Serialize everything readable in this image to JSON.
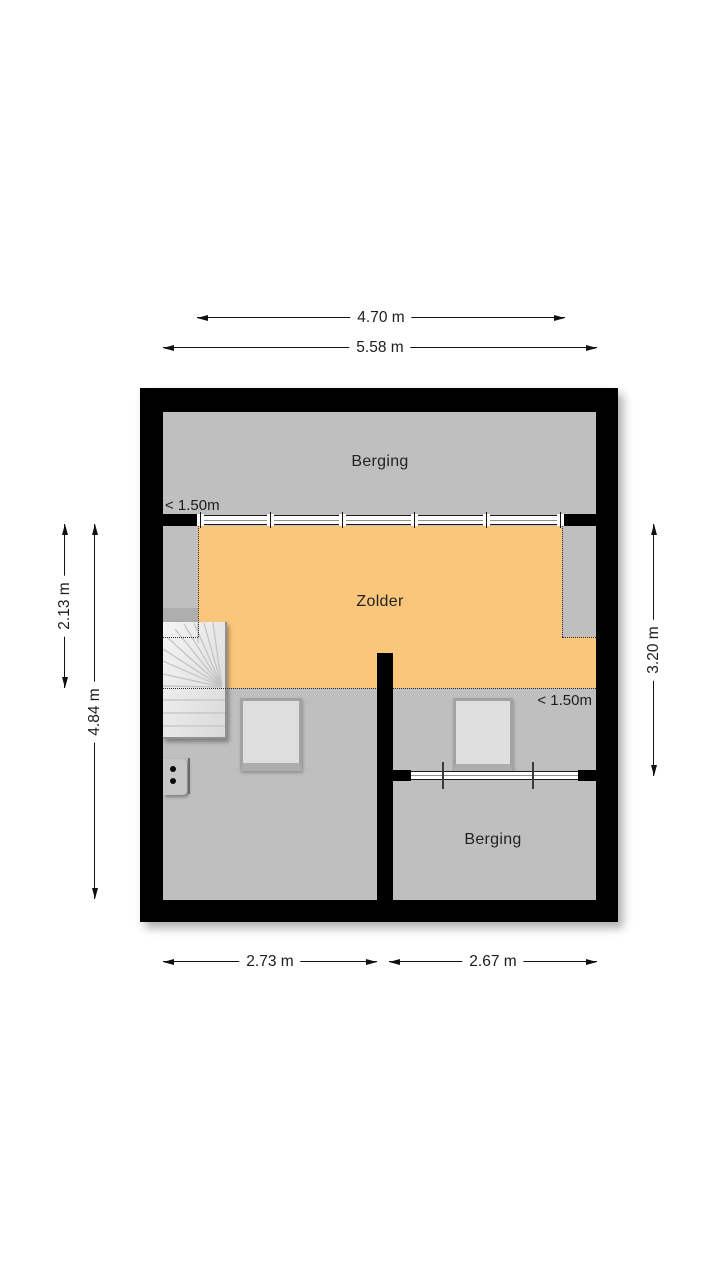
{
  "rooms": {
    "berging_top": "Berging",
    "zolder": "Zolder",
    "berging_bottom": "Berging"
  },
  "height_markers": {
    "top_left": "< 1.50m",
    "bottom_right": "< 1.50m"
  },
  "dimensions": {
    "inner_width_top": "4.70 m",
    "outer_width_top": "5.58 m",
    "left_upper": "2.13 m",
    "left_full": "4.84 m",
    "right_side": "3.20 m",
    "bottom_left_room": "2.73 m",
    "bottom_right_room": "2.67 m"
  },
  "colors": {
    "zolder_fill": "#f9c67c",
    "floor_fill": "#bfbfbf",
    "wall": "#000000",
    "stairs_fill": "#e5e5e5"
  }
}
